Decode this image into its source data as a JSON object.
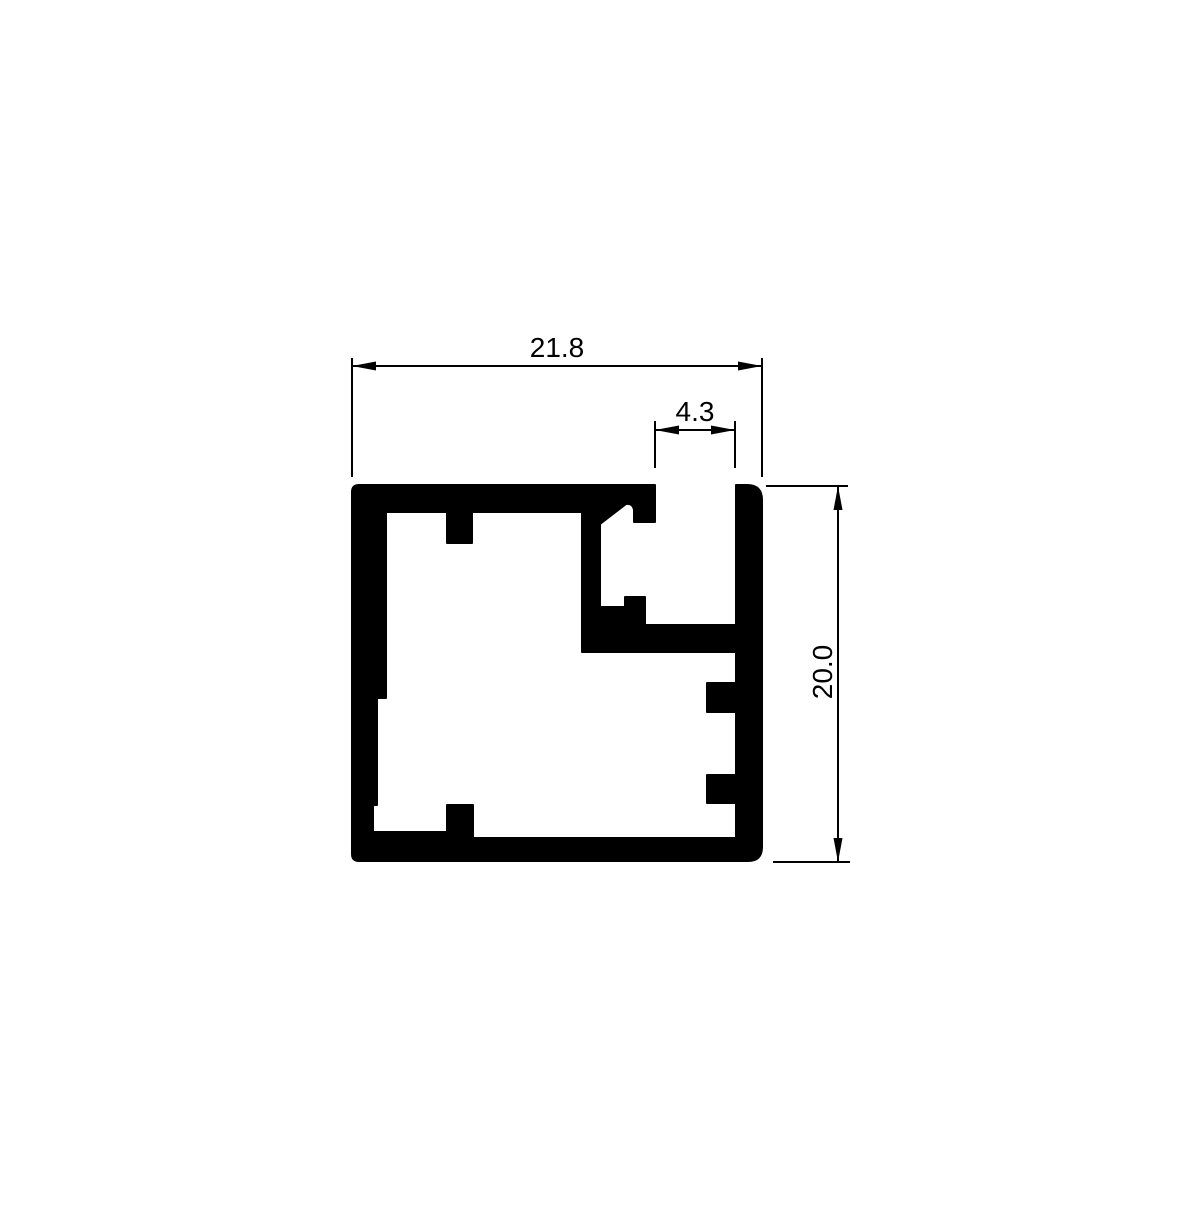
{
  "drawing": {
    "kind": "aluminum-extrusion-profile-cross-section",
    "background_color": "#ffffff",
    "line_color": "#000000",
    "profile_fill_color": "#000000",
    "dimensions": {
      "overall_width": {
        "label": "21.8"
      },
      "slot_opening": {
        "label": "4.3"
      },
      "overall_height": {
        "label": "20.0"
      }
    }
  }
}
